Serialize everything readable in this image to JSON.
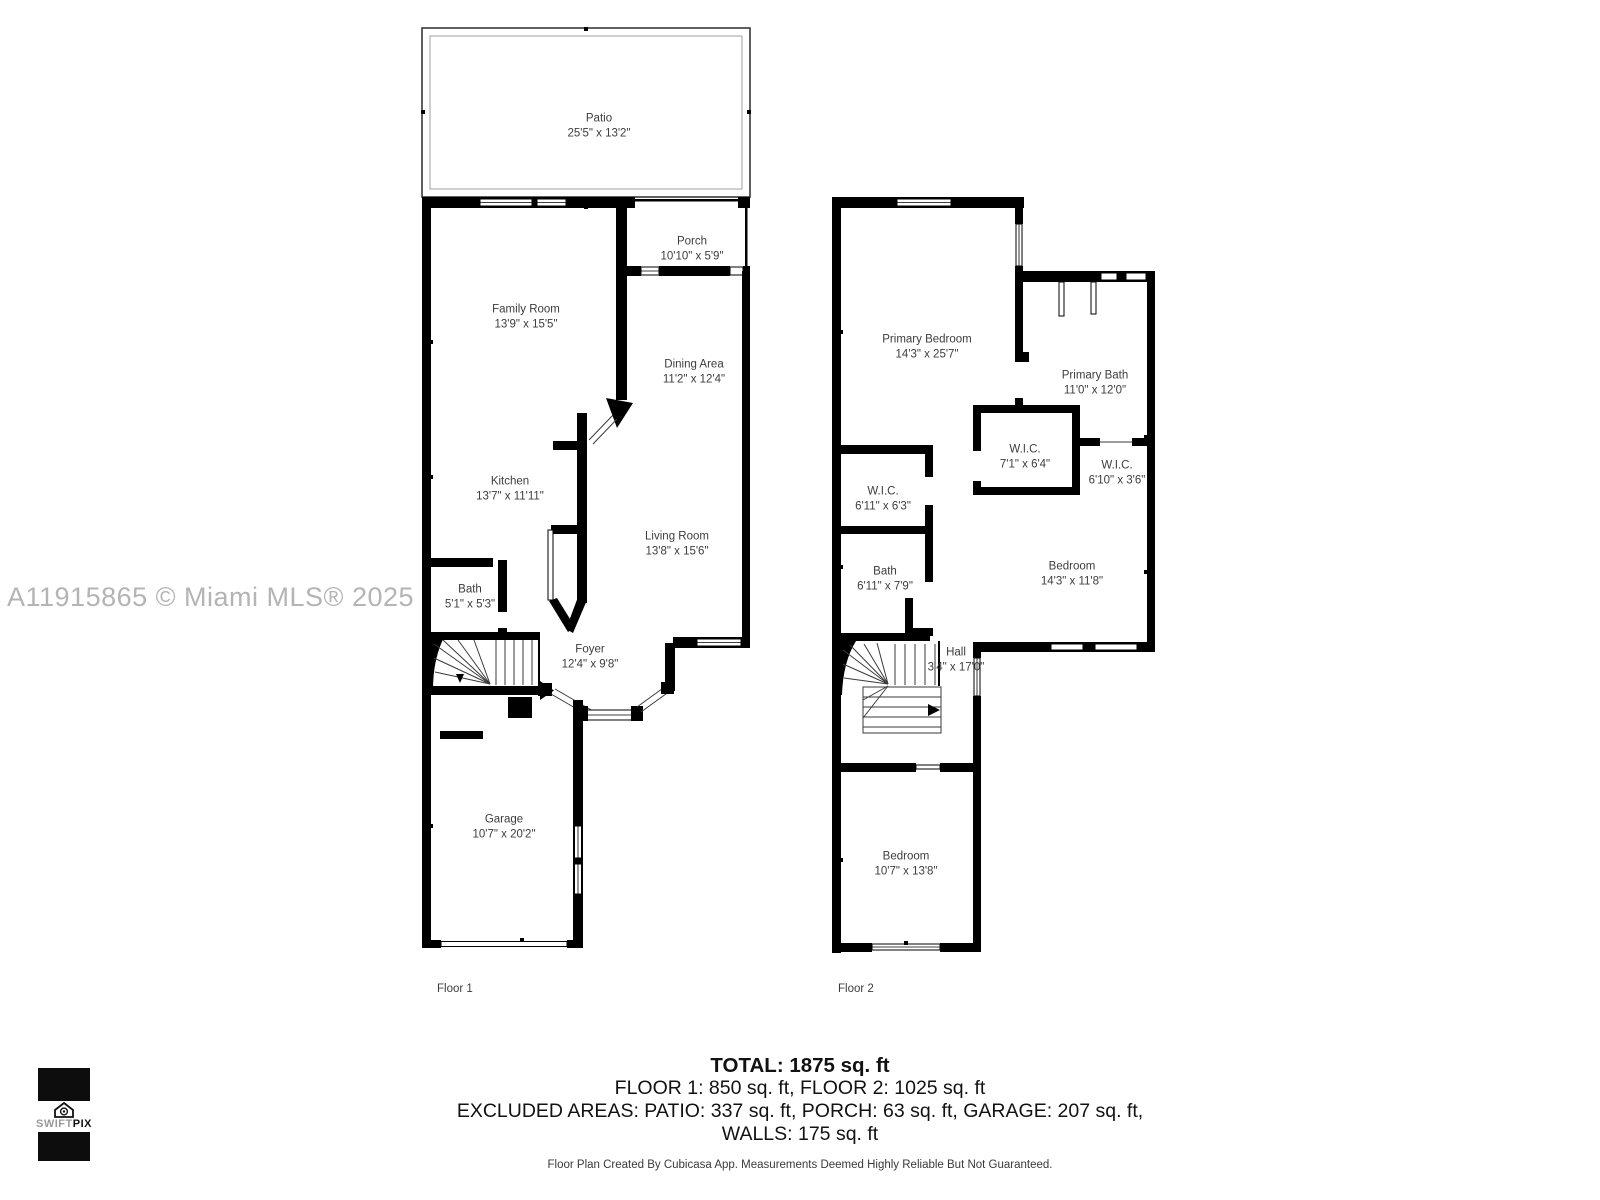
{
  "watermark": "A11915865 © Miami MLS® 2025",
  "floor1": {
    "caption": "Floor 1",
    "rooms": [
      {
        "name": "Patio",
        "dims": "25'5\" x 13'2\""
      },
      {
        "name": "Porch",
        "dims": "10'10\" x 5'9\""
      },
      {
        "name": "Family Room",
        "dims": "13'9\" x 15'5\""
      },
      {
        "name": "Dining Area",
        "dims": "11'2\" x 12'4\""
      },
      {
        "name": "Kitchen",
        "dims": "13'7\" x 11'11\""
      },
      {
        "name": "Living Room",
        "dims": "13'8\" x 15'6\""
      },
      {
        "name": "Bath",
        "dims": "5'1\" x 5'3\""
      },
      {
        "name": "Foyer",
        "dims": "12'4\" x 9'8\""
      },
      {
        "name": "Garage",
        "dims": "10'7\" x 20'2\""
      }
    ]
  },
  "floor2": {
    "caption": "Floor 2",
    "rooms": [
      {
        "name": "Primary Bedroom",
        "dims": "14'3\" x 25'7\""
      },
      {
        "name": "Primary Bath",
        "dims": "11'0\" x 12'0\""
      },
      {
        "name": "W.I.C.",
        "dims": "7'1\" x 6'4\""
      },
      {
        "name": "W.I.C.",
        "dims": "6'10\" x 3'6\""
      },
      {
        "name": "W.I.C.",
        "dims": "6'11\" x 6'3\""
      },
      {
        "name": "Bath",
        "dims": "6'11\" x 7'9\""
      },
      {
        "name": "Bedroom",
        "dims": "14'3\" x 11'8\""
      },
      {
        "name": "Hall",
        "dims": "3'4\" x 17'0\""
      },
      {
        "name": "Bedroom",
        "dims": "10'7\" x 13'8\""
      }
    ]
  },
  "summary": {
    "total": "TOTAL: 1875 sq. ft",
    "floors": "FLOOR 1: 850 sq. ft, FLOOR 2: 1025 sq. ft",
    "excluded": "EXCLUDED AREAS: PATIO: 337 sq. ft, PORCH: 63 sq. ft, GARAGE: 207 sq. ft,",
    "walls": "WALLS: 175 sq. ft",
    "disclaimer": "Floor Plan Created By Cubicasa App. Measurements Deemed Highly Reliable But Not Guaranteed."
  },
  "logo": {
    "brand_light": "SWIFT",
    "brand_bold": "PIX"
  },
  "colors": {
    "wall": "#000000",
    "label": "#3d3d3d",
    "watermark": "#b4b4b4"
  }
}
